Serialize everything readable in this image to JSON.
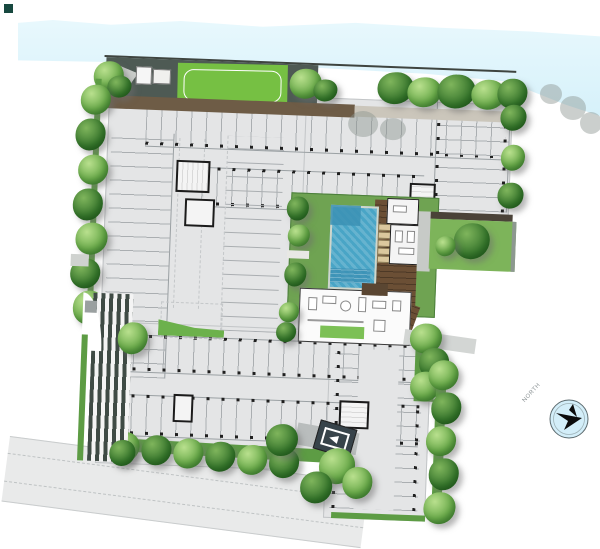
{
  "meta": {
    "title": "Residential development ground-floor site / landscape plan",
    "drawing_type": "architectural-site-plan",
    "orientation_note": "building mass tilted slightly clockwise; canal across top; access road at bottom"
  },
  "compass": {
    "label": "NORTH"
  },
  "palette": {
    "water": "#d6f1fa",
    "site_gray": "#e4e5e6",
    "stall_line": "#aaaeb1",
    "column_tick": "#1f1f1f",
    "lawn": "#76c043",
    "hedge": "#5d9c44",
    "tree_mid": "#6fae4e",
    "tree_dark": "#3c7a30",
    "pool_water": "#49a5c6",
    "pool_deep": "#3b90b4",
    "timber_deck": "#6b4f35",
    "lounger_tan": "#dbc89e",
    "terrace_dark": "#4e5a54",
    "walkway_brown": "#6e5c46",
    "road": "#e9eaea",
    "ramp_stripe_dark": "#3f4b45",
    "entrance_canopy": "#37434a",
    "compass_fill": "#d3eef9"
  },
  "plan": {
    "areas": [
      {
        "id": "canal",
        "label": "Canal / river along north edge"
      },
      {
        "id": "riverfront-terrace",
        "label": "Dark paved riverfront terrace with pavilion"
      },
      {
        "id": "activity-lawn",
        "label": "Activity lawn with white loop path"
      },
      {
        "id": "perimeter-trees",
        "label": "Perimeter tree and hedge buffer (west, east, south)"
      },
      {
        "id": "parking-deck",
        "label": "Ground floor parking rows with column ticks"
      },
      {
        "id": "stair-cores",
        "label": "Stair / lift cores",
        "count": 5
      },
      {
        "id": "courtyard",
        "label": "Central landscaped courtyard"
      },
      {
        "id": "pool",
        "label": "Swimming pool with stepped shallow zones"
      },
      {
        "id": "loungers",
        "label": "Sun loungers beside pool",
        "count": 5
      },
      {
        "id": "pool-deck",
        "label": "Timber pool deck"
      },
      {
        "id": "clubhouse",
        "label": "Clubhouse / fitness rooms"
      },
      {
        "id": "lobby",
        "label": "Lobby lounge with furniture"
      },
      {
        "id": "garden-pocket",
        "label": "East garden pocket with large tree"
      },
      {
        "id": "entry-ramp",
        "label": "Striped vehicular entry ramp (west)"
      },
      {
        "id": "access-road",
        "label": "Access road along south edge"
      },
      {
        "id": "entrance-canopy",
        "label": "Entrance court canopy / signage marker"
      },
      {
        "id": "north-arrow",
        "label": "North arrow compass"
      }
    ]
  }
}
